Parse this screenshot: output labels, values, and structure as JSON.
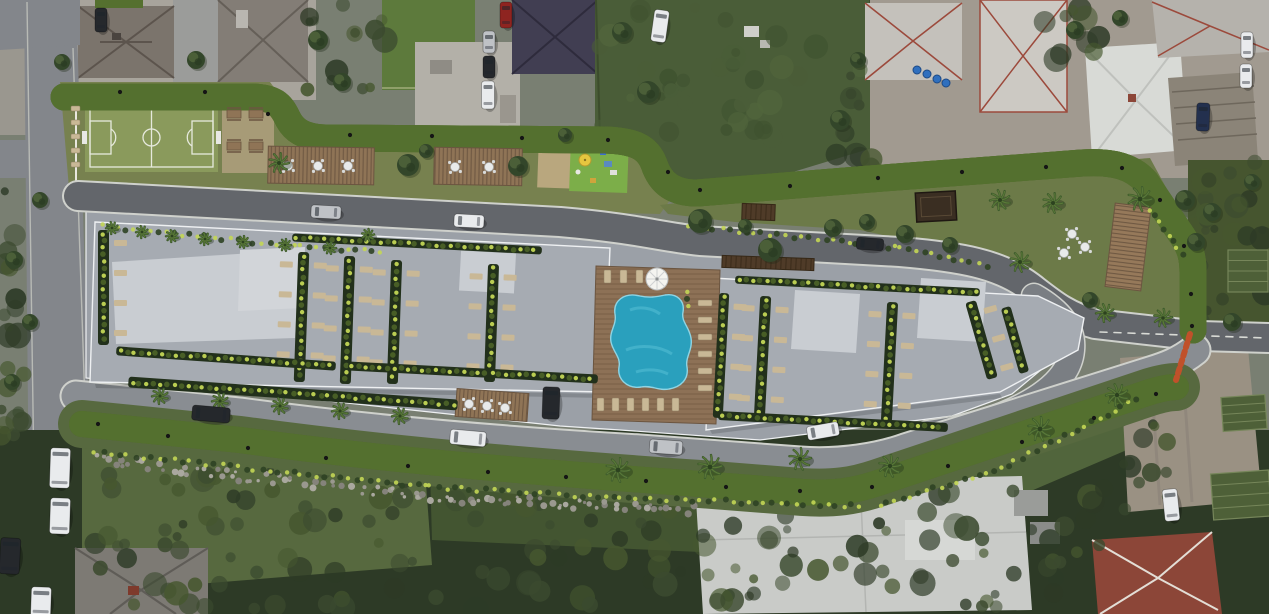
{
  "palette": {
    "base": "#797f72",
    "road": "#85888d",
    "road_dark": "#63666b",
    "road_mid": "#7a7e83",
    "road_light": "#898d92",
    "road_left": "#83868b",
    "road_edge": "#d6d8d2",
    "plaza": "#9ba0a7",
    "roof": "#a6abb2",
    "roof_light": "#c9cdd2",
    "roof_edge": "#eef0f2",
    "track": "#c0512a",
    "track_dark": "#9e401f",
    "verge": "#55702f",
    "white_line": "#e9e7df",
    "field": "#8a9a5c",
    "field_line": "#e6e9dd",
    "grass": "#77814f",
    "garden": "#6c7a48",
    "lawn": "#57693f",
    "lawn2": "#4a5d38",
    "veg": "#3b4a2f",
    "veg_dark": "#2d3a26",
    "veg_light": "#51653c",
    "tree": "#33462a",
    "palm": "#3f5c2d",
    "palm_light": "#5e7c3a",
    "sand": "#b9a77e",
    "sand_dark": "#a79b77",
    "wood": "#8f7456",
    "wood_dark": "#6b5540",
    "deck": "#8d7156",
    "fence": "#4f3b28",
    "gazebo": "#3a2e22",
    "pool": "#2aa0bd",
    "pool_light": "#55c0d6",
    "pool_edge": "#8ed4e4",
    "bush_lit": "#c3d655",
    "bush": "#2f4323",
    "bush_mid": "#4c6428",
    "lounger": "#c9b896",
    "table_white": "#e8eaea",
    "ctx_pale": "#a8a49c",
    "ctx_pale2": "#a19a90",
    "concrete": "#b3b0a8",
    "driveway": "#9b9c9a",
    "roof_a": "#7b746c",
    "roof_b": "#837d76",
    "roof_navy": "#413e52",
    "roof_white": "#d8dad6",
    "roof_gray": "#c4c1bb",
    "ridge_red": "#9c4a3c",
    "roof_slat": "#8b8478",
    "roof_tile": "#8c4638",
    "roof_house": "#7d7a74",
    "bldg_white": "#c9cbc8",
    "dirt": "#9a9183",
    "stone": "#9a988f",
    "barrel": "#2f6fbe",
    "umb_yellow": "#e6c63f",
    "umb_white": "#f4f4f0",
    "car_white": "#e9ebed",
    "car_silver": "#bfc2c6",
    "car_dark": "#25282c",
    "car_red": "#8e2420",
    "car_navy": "#23304e",
    "bed": "#4e6038",
    "bed_line": "#76865a"
  },
  "scene": {
    "track_lights": [
      [
        120,
        92
      ],
      [
        205,
        92
      ],
      [
        268,
        114
      ],
      [
        350,
        135
      ],
      [
        432,
        136
      ],
      [
        522,
        138
      ],
      [
        608,
        140
      ],
      [
        668,
        172
      ],
      [
        700,
        190
      ],
      [
        790,
        186
      ],
      [
        878,
        178
      ],
      [
        962,
        172
      ],
      [
        1046,
        167
      ],
      [
        1122,
        168
      ],
      [
        1160,
        200
      ],
      [
        1184,
        246
      ],
      [
        1191,
        294
      ],
      [
        1192,
        326
      ],
      [
        98,
        424
      ],
      [
        168,
        436
      ],
      [
        248,
        448
      ],
      [
        326,
        458
      ],
      [
        408,
        466
      ],
      [
        488,
        472
      ],
      [
        566,
        477
      ],
      [
        646,
        481
      ],
      [
        726,
        487
      ],
      [
        800,
        491
      ],
      [
        872,
        487
      ],
      [
        948,
        466
      ],
      [
        1022,
        442
      ],
      [
        1094,
        418
      ],
      [
        1156,
        394
      ]
    ],
    "cars": [
      [
        326,
        212,
        30,
        13,
        3,
        "car_silver"
      ],
      [
        469,
        221,
        30,
        13,
        3,
        "car_white"
      ],
      [
        870,
        244,
        27,
        12,
        4,
        "car_dark"
      ],
      [
        468,
        438,
        36,
        15,
        5,
        "car_white"
      ],
      [
        666,
        447,
        33,
        14,
        4,
        "car_silver"
      ],
      [
        823,
        431,
        32,
        14,
        -10,
        "car_white"
      ],
      [
        211,
        414,
        38,
        15,
        5,
        "car_dark"
      ],
      [
        551,
        403,
        17,
        32,
        2,
        "car_dark"
      ],
      [
        60,
        468,
        20,
        40,
        2,
        "car_white"
      ],
      [
        60,
        516,
        20,
        36,
        2,
        "car_white"
      ],
      [
        10,
        556,
        20,
        36,
        3,
        "car_dark"
      ],
      [
        41,
        602,
        20,
        30,
        2,
        "car_white"
      ],
      [
        101,
        20,
        12,
        24,
        0,
        "car_dark"
      ],
      [
        506,
        15,
        12,
        26,
        0,
        "car_red"
      ],
      [
        489,
        42,
        12,
        22,
        0,
        "car_silver"
      ],
      [
        489,
        67,
        12,
        22,
        0,
        "car_dark"
      ],
      [
        488,
        95,
        13,
        28,
        0,
        "car_white"
      ],
      [
        660,
        26,
        15,
        32,
        8,
        "car_white"
      ],
      [
        1203,
        117,
        13,
        28,
        2,
        "car_navy"
      ],
      [
        1247,
        45,
        12,
        26,
        0,
        "car_white"
      ],
      [
        1246,
        76,
        12,
        24,
        0,
        "car_white"
      ],
      [
        1171,
        505,
        15,
        32,
        -6,
        "car_white"
      ]
    ],
    "palms": [
      [
        279,
        163,
        10
      ],
      [
        1000,
        200,
        10
      ],
      [
        1053,
        203,
        10
      ],
      [
        1140,
        199,
        12
      ],
      [
        1020,
        262,
        10
      ],
      [
        1105,
        313,
        9
      ],
      [
        1163,
        318,
        9
      ],
      [
        1117,
        395,
        11
      ],
      [
        160,
        396,
        8
      ],
      [
        220,
        401,
        8
      ],
      [
        280,
        406,
        8
      ],
      [
        340,
        411,
        8
      ],
      [
        400,
        416,
        8
      ],
      [
        618,
        470,
        12
      ],
      [
        710,
        467,
        12
      ],
      [
        800,
        459,
        11
      ],
      [
        890,
        466,
        11
      ],
      [
        1040,
        429,
        12
      ],
      [
        112,
        228,
        6
      ],
      [
        142,
        232,
        6
      ],
      [
        172,
        236,
        6
      ],
      [
        205,
        239,
        6
      ],
      [
        243,
        242,
        6
      ],
      [
        285,
        245,
        6
      ],
      [
        330,
        248,
        6
      ],
      [
        368,
        235,
        6
      ]
    ],
    "trees": [
      [
        700,
        221,
        12
      ],
      [
        770,
        250,
        12
      ],
      [
        833,
        228,
        9
      ],
      [
        905,
        234,
        9
      ],
      [
        867,
        222,
        8
      ],
      [
        950,
        245,
        8
      ],
      [
        1090,
        300,
        8
      ],
      [
        408,
        165,
        11
      ],
      [
        426,
        151,
        7
      ],
      [
        518,
        166,
        10
      ],
      [
        745,
        226,
        7
      ],
      [
        565,
        135,
        7
      ],
      [
        196,
        60,
        9
      ],
      [
        62,
        62,
        8
      ],
      [
        318,
        40,
        10
      ],
      [
        342,
        82,
        9
      ],
      [
        622,
        32,
        10
      ],
      [
        648,
        92,
        11
      ],
      [
        840,
        120,
        10
      ],
      [
        858,
        60,
        8
      ],
      [
        1075,
        30,
        9
      ],
      [
        1120,
        18,
        8
      ],
      [
        1185,
        200,
        10
      ],
      [
        1212,
        212,
        9
      ],
      [
        1196,
        242,
        9
      ],
      [
        1232,
        322,
        9
      ],
      [
        1252,
        182,
        8
      ],
      [
        14,
        260,
        9
      ],
      [
        30,
        322,
        8
      ],
      [
        12,
        382,
        8
      ],
      [
        40,
        200,
        8
      ]
    ],
    "green_strips": [
      [
        98,
        230,
        11,
        115,
        0,
        2
      ],
      [
        296,
        252,
        11,
        130,
        2,
        3
      ],
      [
        342,
        256,
        11,
        128,
        2,
        3
      ],
      [
        389,
        260,
        11,
        124,
        2,
        3
      ],
      [
        486,
        264,
        11,
        118,
        2,
        3
      ],
      [
        292,
        240,
        250,
        8,
        3,
        0
      ],
      [
        116,
        354,
        220,
        9,
        4,
        0
      ],
      [
        348,
        368,
        250,
        9,
        3,
        0
      ],
      [
        735,
        282,
        245,
        8,
        3,
        0
      ],
      [
        716,
        293,
        10,
        125,
        3,
        2
      ],
      [
        757,
        296,
        11,
        124,
        3,
        3
      ],
      [
        884,
        302,
        11,
        120,
        3,
        3
      ],
      [
        976,
        300,
        11,
        80,
        -16,
        2
      ],
      [
        1010,
        306,
        10,
        68,
        -16,
        0
      ],
      [
        718,
        417,
        230,
        9,
        3,
        0
      ],
      [
        128,
        388,
        330,
        11,
        4,
        0
      ]
    ],
    "bush_rows": [
      [
        [
          95,
          452
        ],
        [
          300,
          474
        ],
        [
          430,
          487
        ],
        [
          620,
          498
        ],
        [
          860,
          506
        ]
      ],
      [
        [
          880,
          506
        ],
        [
          1000,
          468
        ],
        [
          1140,
          398
        ]
      ],
      [
        [
          690,
          226
        ],
        [
          900,
          248
        ],
        [
          990,
          266
        ]
      ],
      [
        [
          1150,
          210
        ],
        [
          1185,
          260
        ]
      ],
      [
        [
          687,
          292
        ],
        [
          687,
          316
        ]
      ],
      [
        [
          102,
          226
        ],
        [
          300,
          247
        ],
        [
          380,
          252
        ]
      ]
    ],
    "stone_rows": [
      [
        [
          95,
          455
        ],
        [
          240,
          472
        ],
        [
          420,
          492
        ],
        [
          560,
          500
        ]
      ],
      [
        [
          560,
          500
        ],
        [
          700,
          506
        ]
      ]
    ],
    "furniture_rows": [
      {
        "x": 604,
        "y": 270,
        "n": 4,
        "dx": 16,
        "dy": 0,
        "w": 7,
        "h": 13
      },
      {
        "x": 698,
        "y": 300,
        "n": 6,
        "dx": 0,
        "dy": 17,
        "w": 14,
        "h": 6
      },
      {
        "x": 597,
        "y": 398,
        "n": 6,
        "dx": 15,
        "dy": 0,
        "w": 7,
        "h": 13
      },
      {
        "x": 71,
        "y": 106,
        "n": 5,
        "dx": 0,
        "dy": 14,
        "w": 9,
        "h": 5
      }
    ],
    "tables": [
      [
        288,
        166
      ],
      [
        318,
        166
      ],
      [
        348,
        166
      ],
      [
        455,
        167
      ],
      [
        489,
        167
      ],
      [
        469,
        404
      ],
      [
        487,
        406
      ],
      [
        505,
        408
      ],
      [
        1072,
        234
      ],
      [
        1085,
        247
      ],
      [
        1064,
        253
      ]
    ],
    "picnic": [
      [
        234,
        114
      ],
      [
        256,
        114
      ],
      [
        234,
        146
      ],
      [
        256,
        146
      ]
    ],
    "decks": [
      {
        "x": 268,
        "y": 147,
        "w": 106,
        "h": 37,
        "r": 1
      },
      {
        "x": 434,
        "y": 148,
        "w": 88,
        "h": 37,
        "r": 1
      },
      {
        "x": 456,
        "y": 391,
        "w": 72,
        "h": 28,
        "r": 4
      },
      {
        "x": 1110,
        "y": 205,
        "w": 36,
        "h": 84,
        "r": 7
      }
    ],
    "fences": [
      {
        "x": 742,
        "y": 204,
        "w": 33,
        "h": 16,
        "r": 2
      },
      {
        "x": 722,
        "y": 257,
        "w": 92,
        "h": 12,
        "r": 2
      }
    ],
    "gazebo": {
      "x": 916,
      "y": 192,
      "w": 40,
      "h": 29,
      "r": -3
    },
    "garden_beds": [
      {
        "x": 1212,
        "y": 472,
        "w": 58,
        "h": 46,
        "r": -4
      },
      {
        "x": 1222,
        "y": 396,
        "w": 44,
        "h": 34,
        "r": -4
      },
      {
        "x": 1228,
        "y": 250,
        "w": 40,
        "h": 42,
        "r": 0
      }
    ],
    "barrels": [
      [
        917,
        70
      ],
      [
        927,
        74
      ],
      [
        937,
        79
      ],
      [
        946,
        83
      ]
    ],
    "umbrellas": {
      "pool": {
        "x": 657,
        "y": 279,
        "r": 11
      },
      "playground": {
        "x": 585,
        "y": 160,
        "r": 6
      }
    }
  }
}
